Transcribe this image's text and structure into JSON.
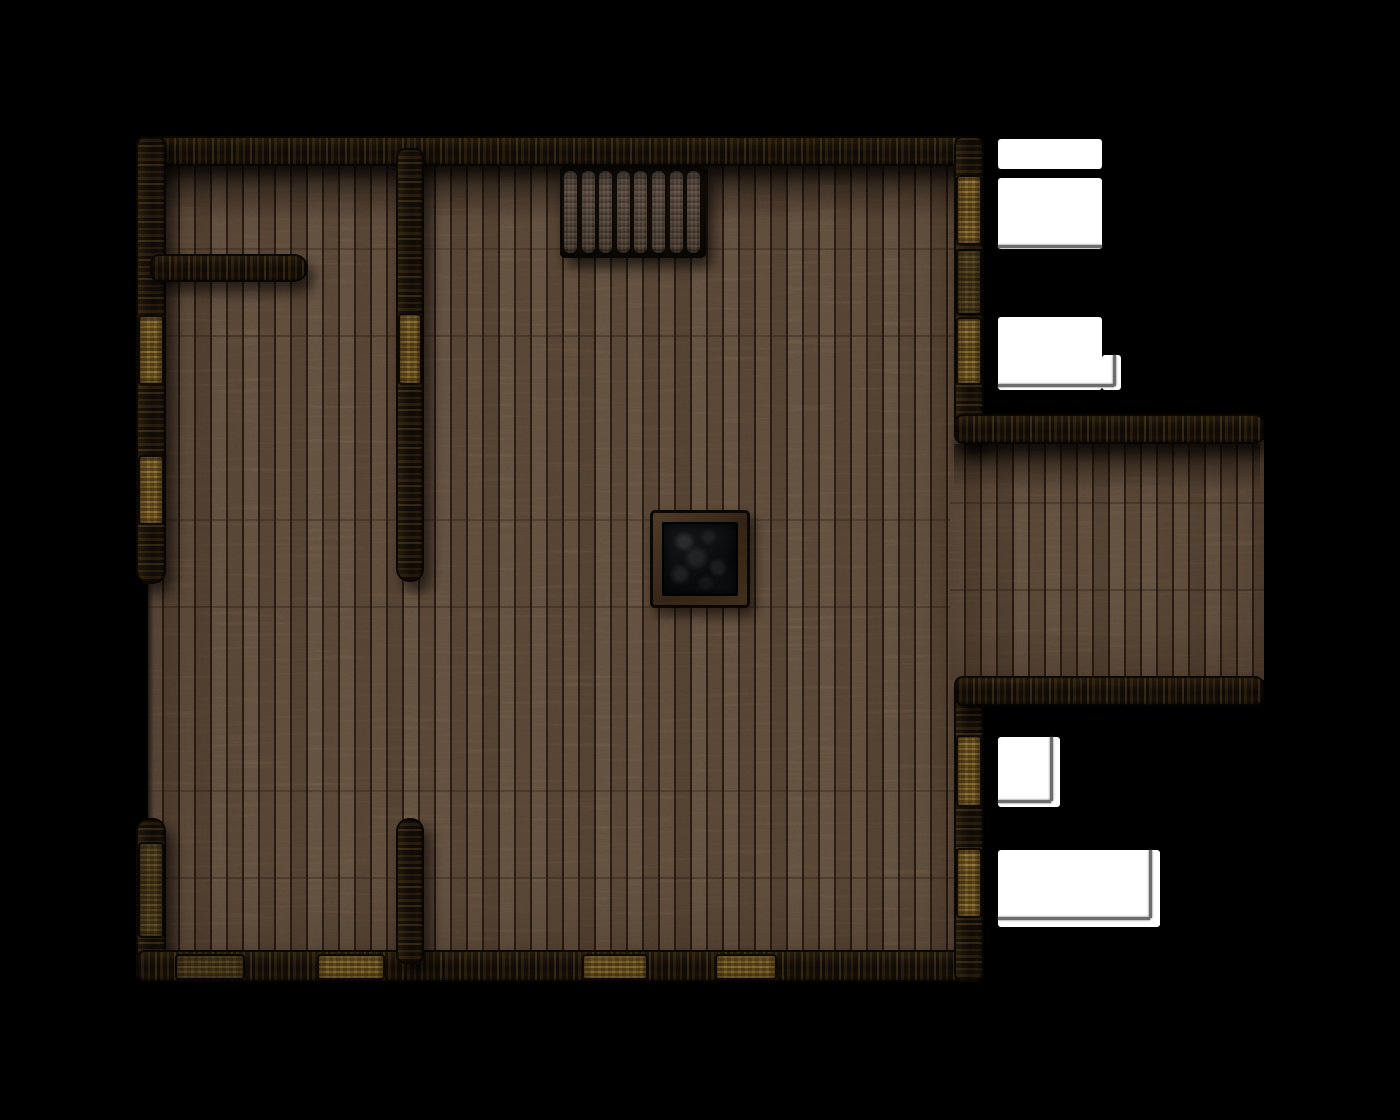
{
  "scene": {
    "type": "top-down wooden building battle map",
    "background_color": "#000000",
    "grid_visible": false
  },
  "palette": {
    "background": "#000000",
    "floor_plank": "#8b6e55",
    "floor_seam": "#26190f",
    "wall_dark": "#241a10",
    "wall_gold_fleck": "#c79b47",
    "door_gold": "#c79b47",
    "stair_tread": "#8a7260",
    "stair_well": "#1c130c",
    "pit_frame": "#5c452b",
    "pit_rock": "#1a1c1f",
    "light_area": "#ffffff",
    "cast_shadow_line": "#6d6d6d"
  },
  "map_bounds": {
    "x": 130,
    "y": 130,
    "w": 1140,
    "h": 860
  },
  "floors": [
    {
      "name": "main-room-floor",
      "x": 148,
      "y": 148,
      "w": 824,
      "h": 820
    },
    {
      "name": "annex-floor",
      "x": 950,
      "y": 440,
      "w": 314,
      "h": 240
    }
  ],
  "shadow_bands": [
    {
      "name": "floor-shadow-top",
      "grad": "down",
      "x": 150,
      "y": 166,
      "w": 818,
      "h": 54
    },
    {
      "name": "floor-shadow-annex-top",
      "grad": "down",
      "x": 954,
      "y": 444,
      "w": 306,
      "h": 46
    },
    {
      "name": "floor-edge-left-opening",
      "grad": "rightdark",
      "x": 146,
      "y": 578,
      "w": 8,
      "h": 244
    }
  ],
  "walls": [
    {
      "name": "wall-top",
      "o": "h",
      "x": 136,
      "y": 136,
      "w": 848,
      "h": 30
    },
    {
      "name": "wall-left-upper",
      "o": "v",
      "r": "rb",
      "x": 136,
      "y": 136,
      "w": 30,
      "h": 448
    },
    {
      "name": "wall-left-lower",
      "o": "v",
      "r": "rt",
      "x": 136,
      "y": 818,
      "w": 30,
      "h": 164
    },
    {
      "name": "wall-bottom",
      "o": "h",
      "x": 136,
      "y": 950,
      "w": 848,
      "h": 32
    },
    {
      "name": "wall-right-upper",
      "o": "v",
      "x": 954,
      "y": 136,
      "w": 30,
      "h": 308
    },
    {
      "name": "wall-right-lower",
      "o": "v",
      "x": 954,
      "y": 676,
      "w": 30,
      "h": 306
    },
    {
      "name": "annex-wall-top",
      "o": "h",
      "x": 954,
      "y": 414,
      "w": 310,
      "h": 30
    },
    {
      "name": "annex-wall-bottom",
      "o": "h",
      "x": 954,
      "y": 676,
      "w": 310,
      "h": 30
    },
    {
      "name": "partition-wall-horizontal",
      "o": "h",
      "r": "rr",
      "x": 150,
      "y": 254,
      "w": 158,
      "h": 28
    },
    {
      "name": "partition-wall-vertical-upper",
      "o": "v",
      "r": "rb",
      "x": 396,
      "y": 148,
      "w": 28,
      "h": 434
    },
    {
      "name": "partition-wall-vertical-lower",
      "o": "v",
      "r": "rt",
      "x": 396,
      "y": 818,
      "w": 28,
      "h": 146
    }
  ],
  "doors": [
    {
      "name": "door-left-1",
      "tone": "bright",
      "x": 138,
      "y": 315,
      "w": 26,
      "h": 70
    },
    {
      "name": "door-left-2",
      "tone": "bright",
      "x": 138,
      "y": 455,
      "w": 26,
      "h": 70
    },
    {
      "name": "door-left-3",
      "tone": "dim",
      "x": 138,
      "y": 842,
      "w": 26,
      "h": 96
    },
    {
      "name": "door-partition",
      "tone": "bright",
      "x": 398,
      "y": 313,
      "w": 24,
      "h": 72
    },
    {
      "name": "door-right-1",
      "tone": "bright",
      "x": 956,
      "y": 175,
      "w": 26,
      "h": 70
    },
    {
      "name": "door-right-2",
      "tone": "dim",
      "x": 956,
      "y": 249,
      "w": 26,
      "h": 66
    },
    {
      "name": "door-right-3",
      "tone": "bright",
      "x": 956,
      "y": 317,
      "w": 26,
      "h": 68
    },
    {
      "name": "door-right-4",
      "tone": "bright",
      "x": 956,
      "y": 735,
      "w": 26,
      "h": 72
    },
    {
      "name": "door-right-5",
      "tone": "bright",
      "x": 956,
      "y": 848,
      "w": 26,
      "h": 70
    },
    {
      "name": "door-bottom-1",
      "tone": "dim",
      "x": 175,
      "y": 954,
      "w": 70,
      "h": 26
    },
    {
      "name": "door-bottom-2",
      "tone": "bright",
      "x": 317,
      "y": 954,
      "w": 68,
      "h": 26
    },
    {
      "name": "door-bottom-3",
      "tone": "bright",
      "x": 582,
      "y": 954,
      "w": 66,
      "h": 26
    },
    {
      "name": "door-bottom-4",
      "tone": "bright",
      "x": 715,
      "y": 954,
      "w": 62,
      "h": 26
    }
  ],
  "white_areas": [
    {
      "name": "light-area-1",
      "x": 998,
      "y": 139,
      "w": 104,
      "h": 30
    },
    {
      "name": "light-area-2",
      "x": 998,
      "y": 178,
      "w": 104,
      "h": 71
    },
    {
      "name": "light-area-3",
      "x": 998,
      "y": 317,
      "w": 104,
      "h": 73
    },
    {
      "name": "light-area-3b",
      "x": 1102,
      "y": 355,
      "w": 19,
      "h": 35
    },
    {
      "name": "light-area-4",
      "x": 998,
      "y": 737,
      "w": 62,
      "h": 70
    },
    {
      "name": "light-area-5",
      "x": 998,
      "y": 850,
      "w": 162,
      "h": 77
    }
  ],
  "shadow_lines": [
    {
      "name": "cast-shadow-line",
      "x": 998,
      "y": 245,
      "w": 104,
      "h": 3
    },
    {
      "name": "cast-shadow-line",
      "x": 998,
      "y": 384,
      "w": 116,
      "h": 3
    },
    {
      "name": "cast-shadow-line",
      "x": 1113,
      "y": 355,
      "w": 3,
      "h": 31
    },
    {
      "name": "cast-shadow-line",
      "x": 1050,
      "y": 737,
      "w": 3,
      "h": 64
    },
    {
      "name": "cast-shadow-line",
      "x": 998,
      "y": 800,
      "w": 53,
      "h": 3
    },
    {
      "name": "cast-shadow-line",
      "x": 1149,
      "y": 850,
      "w": 3,
      "h": 68
    },
    {
      "name": "cast-shadow-line",
      "x": 998,
      "y": 917,
      "w": 152,
      "h": 3
    }
  ],
  "stairs": {
    "x": 560,
    "y": 166,
    "w": 146,
    "h": 92,
    "tread_count": 8,
    "tread": {
      "x0": 4,
      "y0": 5,
      "w": 13,
      "h": 82,
      "step": 17.6
    }
  },
  "pit": {
    "x": 650,
    "y": 510,
    "w": 100,
    "h": 98
  }
}
